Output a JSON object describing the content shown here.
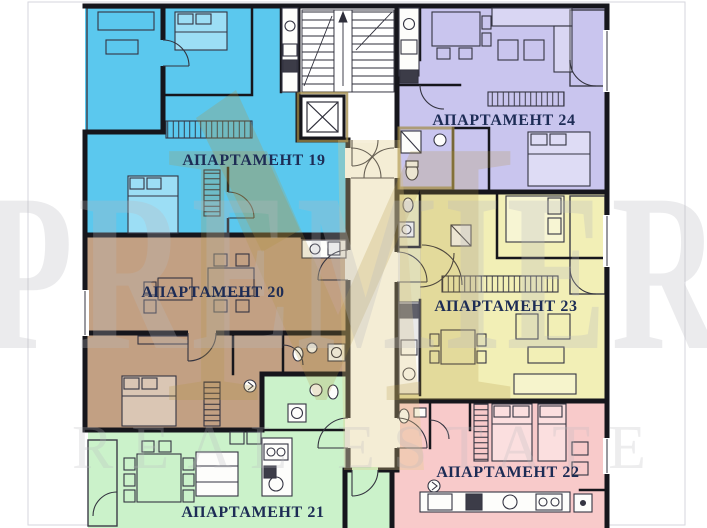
{
  "watermark": {
    "brand": "PREMIER",
    "tagline": "REAL ESTATE",
    "monogram": "M",
    "text_color": "#b9b9bf",
    "logo_color": "#b3953f"
  },
  "plan": {
    "wall_color": "#16161c",
    "label_color": "#1d2c55",
    "apartments": [
      {
        "id": "19",
        "label": "АПАРТАМЕНТ 19",
        "color": "#5bc8ee"
      },
      {
        "id": "20",
        "label": "АПАРТАМЕНТ 20",
        "color": "#c2a083"
      },
      {
        "id": "21",
        "label": "АПАРТАМЕНТ 21",
        "color": "#cbf2ca"
      },
      {
        "id": "22",
        "label": "АПАРТАМЕНТ 22",
        "color": "#f8caca"
      },
      {
        "id": "23",
        "label": "АПАРТАМЕНТ 23",
        "color": "#f2efb6"
      },
      {
        "id": "24",
        "label": "АПАРТАМЕНТ 24",
        "color": "#c9c5ee"
      }
    ]
  }
}
